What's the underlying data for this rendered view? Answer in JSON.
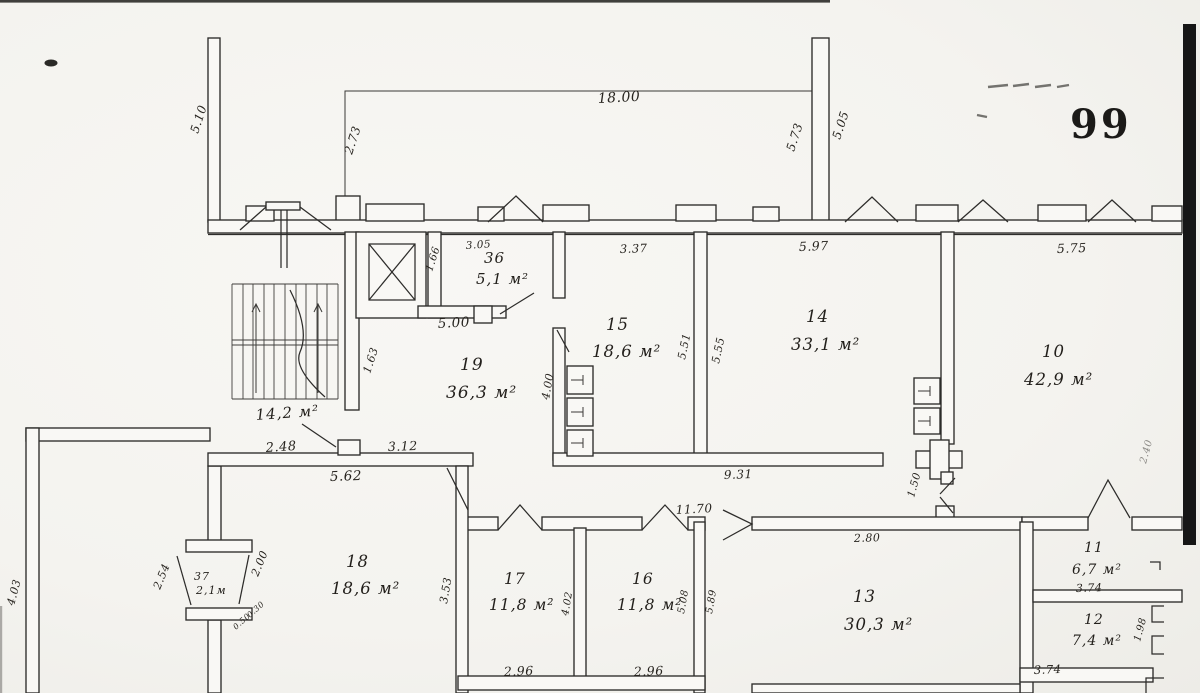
{
  "sheet": {
    "number": "99"
  },
  "plan": {
    "rooms": [
      {
        "number": "19",
        "area": "36,3 м²"
      },
      {
        "number": "36",
        "area": "5,1 м²"
      },
      {
        "number": "15",
        "area": "18,6 м²"
      },
      {
        "number": "14",
        "area": "33,1 м²"
      },
      {
        "number": "10",
        "area": "42,9 м²"
      },
      {
        "number": "18",
        "area": "18,6 м²"
      },
      {
        "number": "17",
        "area": "11,8 м²"
      },
      {
        "number": "16",
        "area": "11,8 м²"
      },
      {
        "number": "13",
        "area": "30,3 м²"
      },
      {
        "number": "11",
        "area": "6,7 м²"
      },
      {
        "number": "12",
        "area": "7,4 м²"
      },
      {
        "number": "37",
        "area": "2,1м"
      }
    ],
    "stairwell_area": "14,2 м²",
    "dims": [
      "18.00",
      "2.73",
      "5.73",
      "5.05",
      "5.10",
      "3.05",
      "1.66",
      "5.00",
      "3.37",
      "5.51",
      "5.55",
      "5.97",
      "5.75",
      "4.00",
      "1.63",
      "2.48",
      "3.12",
      "5.62",
      "9.31",
      "11.70",
      "2.80",
      "1.50",
      "3.53",
      "2.96",
      "2.96",
      "4.02",
      "5.08",
      "5.89",
      "3.74",
      "1.98",
      "3.74",
      "2.54",
      "2.00",
      "0.50",
      "0.30",
      "4.03",
      "2.40"
    ]
  }
}
